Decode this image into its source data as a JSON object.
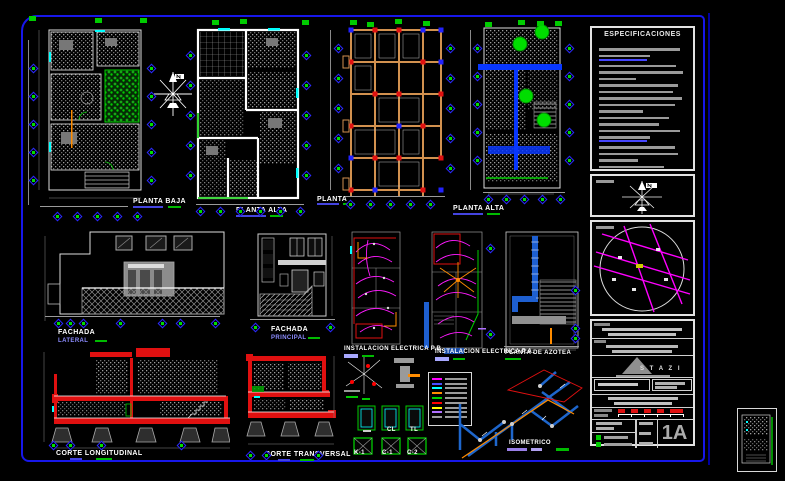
{
  "sheet": {
    "background": "#000000",
    "border_color": "#1717ea",
    "accent_red": "#e01010",
    "accent_green": "#00cc00",
    "accent_magenta": "#ff1aff",
    "accent_orange": "#ff8c00",
    "pipe_blue": "#1e5fd0"
  },
  "labels": {
    "planta_baja": "PLANTA BAJA",
    "planta_alta_1": "PLANTA ALTA",
    "cimentacion": "PLANTA",
    "planta_alta_2": "PLANTA ALTA",
    "fachada_lateral_title": "FACHADA",
    "fachada_lateral_sub": "LATERAL",
    "fachada_principal_title": "FACHADA",
    "fachada_principal_sub": "PRINCIPAL",
    "elec_pb": "INSTALACION ELECTRICA P.B.",
    "elec_pa": "INSTALACION ELECTRICA P.A.",
    "azotea": "PLANTA DE AZOTEA",
    "corte_longitudinal": "CORTE LONGITUDINAL",
    "corte_transversal": "CORTE TRANSVERSAL",
    "isometrico": "ISOMETRICO",
    "detail_cl": "CL",
    "detail_tl": "TL",
    "detail_k1": "K-1",
    "detail_c1": "C-1",
    "detail_c2": "C-2"
  },
  "panel": {
    "specs_title": "ESPECIFICACIONES",
    "logo_text": "S T A Z I",
    "sheet_number": "1A"
  },
  "legend_colors": [
    "#ff00ff",
    "#4b4bff",
    "#00ffff",
    "#ff8c00",
    "#00d000",
    "#ff0000",
    "#ffff00",
    "#b06fff",
    "#9a9a9a"
  ],
  "specs_bars": [
    92,
    58,
    88,
    95,
    42,
    90,
    84,
    94,
    86,
    50,
    80,
    68,
    92,
    58,
    86,
    90,
    44,
    74
  ],
  "markers": [
    [
      33,
      68
    ],
    [
      33,
      96
    ],
    [
      33,
      124
    ],
    [
      33,
      152
    ],
    [
      33,
      180
    ],
    [
      151,
      68
    ],
    [
      151,
      96
    ],
    [
      151,
      124
    ],
    [
      151,
      152
    ],
    [
      151,
      180
    ],
    [
      57,
      216
    ],
    [
      77,
      216
    ],
    [
      97,
      216
    ],
    [
      117,
      216
    ],
    [
      137,
      216
    ],
    [
      190,
      55
    ],
    [
      190,
      85
    ],
    [
      190,
      115
    ],
    [
      190,
      145
    ],
    [
      190,
      175
    ],
    [
      306,
      55
    ],
    [
      306,
      85
    ],
    [
      306,
      115
    ],
    [
      306,
      145
    ],
    [
      306,
      175
    ],
    [
      200,
      211
    ],
    [
      220,
      211
    ],
    [
      240,
      211
    ],
    [
      260,
      211
    ],
    [
      280,
      211
    ],
    [
      300,
      211
    ],
    [
      338,
      48
    ],
    [
      338,
      78
    ],
    [
      338,
      108
    ],
    [
      338,
      138
    ],
    [
      338,
      168
    ],
    [
      450,
      48
    ],
    [
      450,
      78
    ],
    [
      450,
      108
    ],
    [
      450,
      138
    ],
    [
      450,
      168
    ],
    [
      350,
      204
    ],
    [
      370,
      204
    ],
    [
      390,
      204
    ],
    [
      410,
      204
    ],
    [
      430,
      204
    ],
    [
      477,
      48
    ],
    [
      477,
      76
    ],
    [
      477,
      104
    ],
    [
      477,
      132
    ],
    [
      477,
      160
    ],
    [
      569,
      48
    ],
    [
      569,
      76
    ],
    [
      569,
      104
    ],
    [
      569,
      132
    ],
    [
      569,
      160
    ],
    [
      488,
      199
    ],
    [
      506,
      199
    ],
    [
      524,
      199
    ],
    [
      542,
      199
    ],
    [
      560,
      199
    ],
    [
      58,
      323
    ],
    [
      70,
      323
    ],
    [
      83,
      323
    ],
    [
      120,
      323
    ],
    [
      162,
      323
    ],
    [
      180,
      323
    ],
    [
      215,
      323
    ],
    [
      255,
      327
    ],
    [
      330,
      327
    ],
    [
      575,
      290
    ],
    [
      575,
      328
    ],
    [
      575,
      338
    ],
    [
      53,
      445
    ],
    [
      70,
      445
    ],
    [
      101,
      445
    ],
    [
      181,
      445
    ],
    [
      250,
      455
    ],
    [
      266,
      455
    ],
    [
      318,
      455
    ],
    [
      490,
      248
    ],
    [
      490,
      334
    ]
  ],
  "green_markers": [
    [
      32,
      18
    ],
    [
      98,
      20
    ],
    [
      143,
      20
    ],
    [
      215,
      22
    ],
    [
      243,
      21
    ],
    [
      305,
      22
    ],
    [
      353,
      22
    ],
    [
      370,
      24
    ],
    [
      398,
      21
    ],
    [
      426,
      23
    ],
    [
      488,
      24
    ],
    [
      521,
      22
    ],
    [
      540,
      23
    ],
    [
      558,
      23
    ]
  ]
}
